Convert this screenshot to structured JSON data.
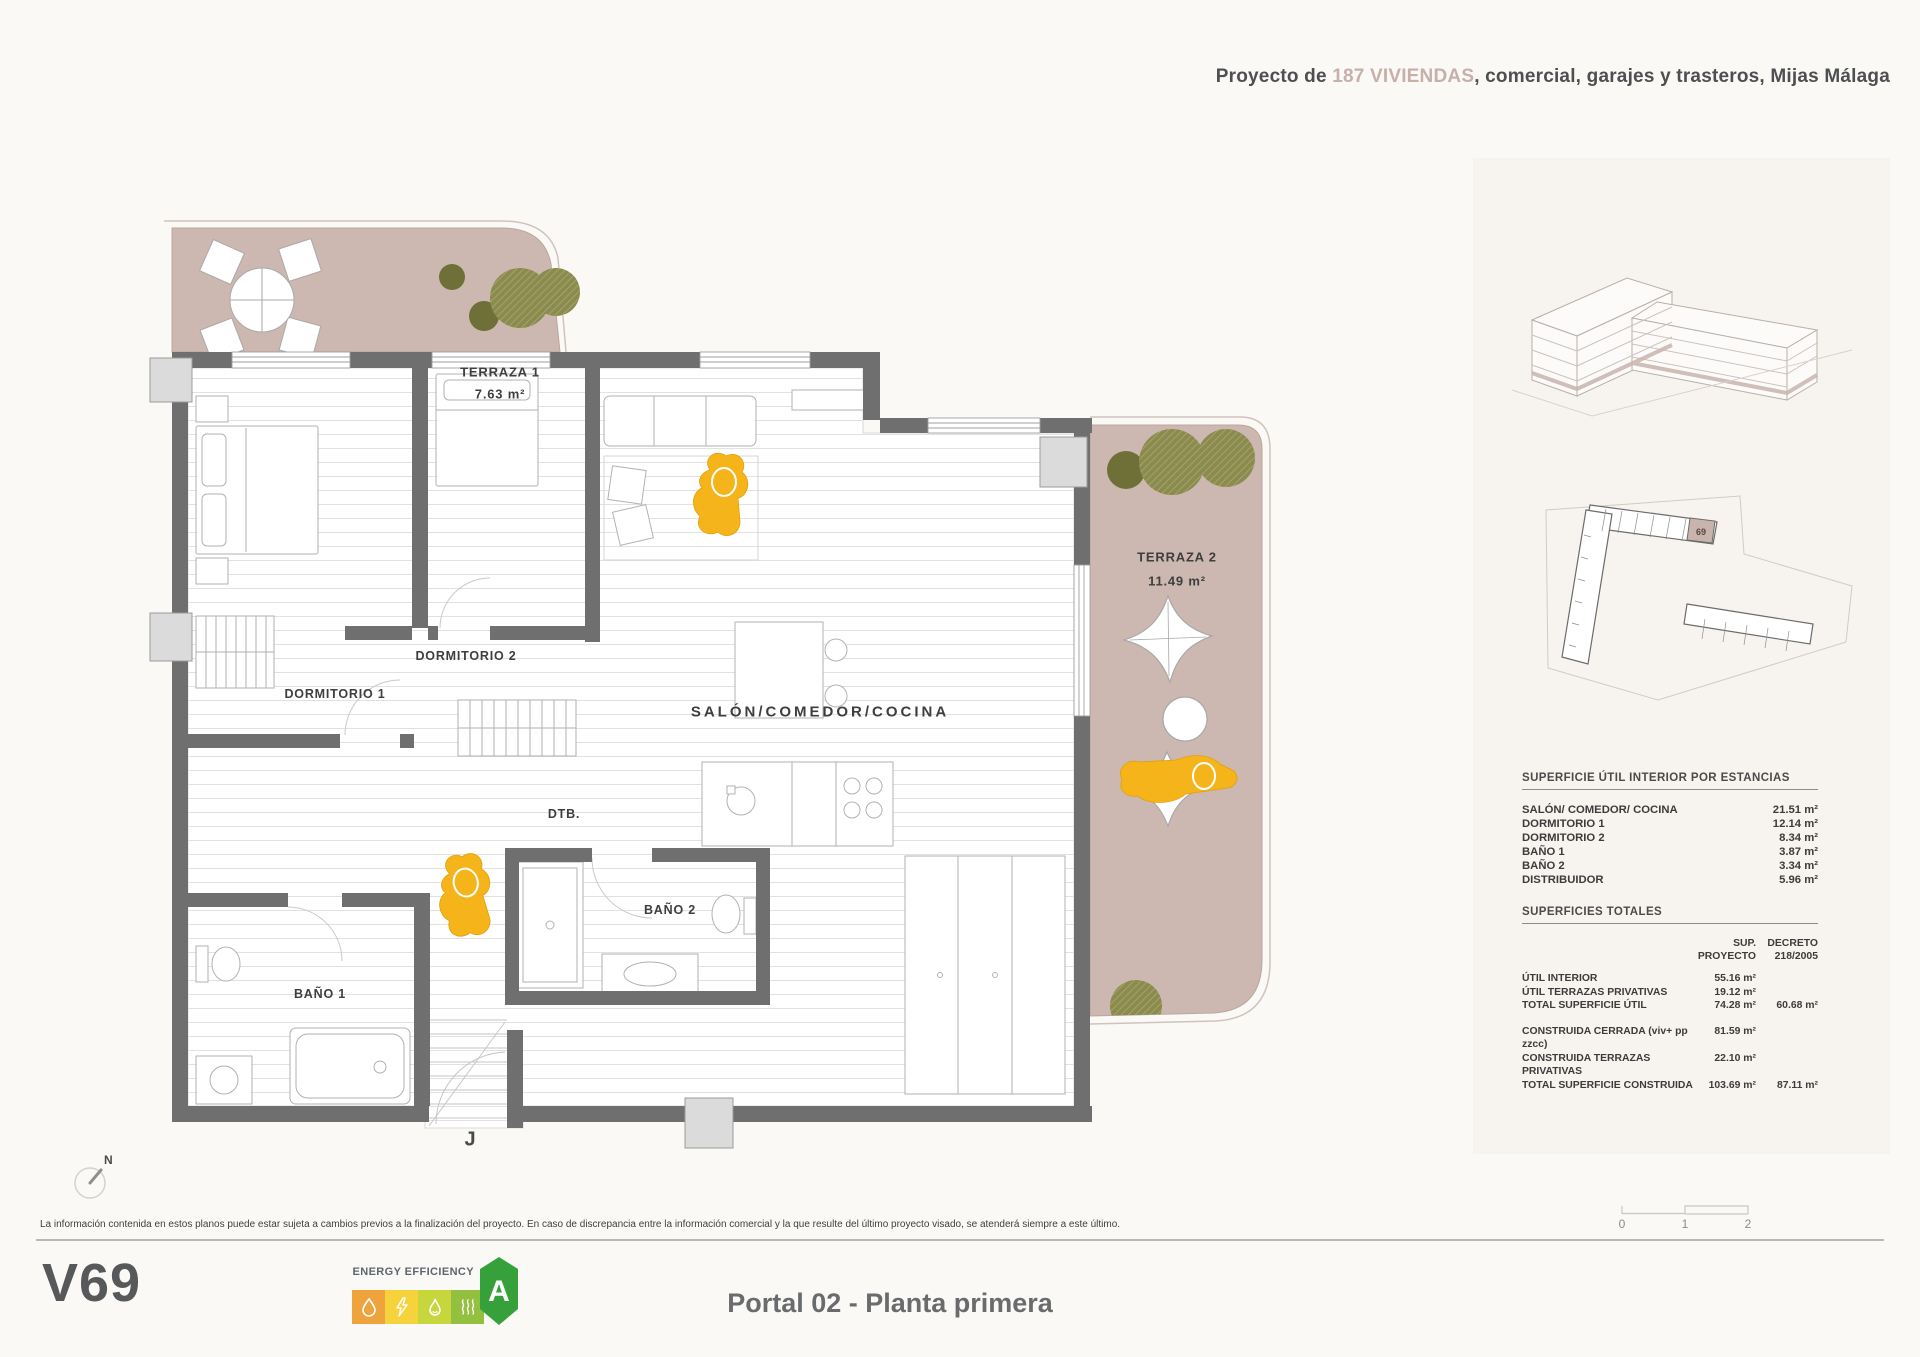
{
  "header": {
    "prefix": "Proyecto de ",
    "highlight": "187 VIVIENDAS",
    "suffix": ", comercial, garajes y trasteros, Mijas Málaga"
  },
  "plan": {
    "terraza1": {
      "name": "TERRAZA 1",
      "area": "7.63 m²"
    },
    "terraza2": {
      "name": "TERRAZA 2",
      "area": "11.49 m²"
    },
    "rooms": {
      "dormitorio1": "DORMITORIO 1",
      "dormitorio2": "DORMITORIO 2",
      "salon": "SALÓN/COMEDOR/COCINA",
      "dtb": "DTB.",
      "bano1": "BAÑO 1",
      "bano2": "BAÑO 2"
    },
    "entry_label": "J",
    "compass": "N"
  },
  "sidebar": {
    "key_unit": "69",
    "interior_table": {
      "title": "SUPERFICIE ÚTIL INTERIOR POR ESTANCIAS",
      "rows": [
        {
          "label": "SALÓN/ COMEDOR/ COCINA",
          "value": "21.51 m²"
        },
        {
          "label": "DORMITORIO 1",
          "value": "12.14 m²"
        },
        {
          "label": "DORMITORIO 2",
          "value": "8.34 m²"
        },
        {
          "label": "BAÑO 1",
          "value": "3.87 m²"
        },
        {
          "label": "BAÑO 2",
          "value": "3.34 m²"
        },
        {
          "label": "DISTRIBUIDOR",
          "value": "5.96 m²"
        }
      ]
    },
    "totals_table": {
      "title": "SUPERFICIES TOTALES",
      "col1_line1": "SUP.",
      "col1_line2": "PROYECTO",
      "col2_line1": "DECRETO",
      "col2_line2": "218/2005",
      "rows": [
        {
          "label": "ÚTIL INTERIOR",
          "sup": "55.16 m²",
          "decreto": ""
        },
        {
          "label": "ÚTIL TERRAZAS PRIVATIVAS",
          "sup": "19.12 m²",
          "decreto": ""
        },
        {
          "label": "TOTAL SUPERFICIE ÚTIL",
          "sup": "74.28 m²",
          "decreto": "60.68 m²"
        },
        {
          "label": "CONSTRUIDA CERRADA (viv+ pp zzcc)",
          "sup": "81.59 m²",
          "decreto": ""
        },
        {
          "label": "CONSTRUIDA TERRAZAS PRIVATIVAS",
          "sup": "22.10 m²",
          "decreto": ""
        },
        {
          "label": "TOTAL SUPERFICIE CONSTRUIDA",
          "sup": "103.69 m²",
          "decreto": "87.11 m²"
        }
      ]
    }
  },
  "scalebar": {
    "labels": [
      "0",
      "1",
      "2"
    ]
  },
  "footer": {
    "disclaimer": "La información contenida en estos planos puede estar sujeta a cambios previos a la finalización del proyecto. En caso de discrepancia entre la información comercial y la que resulte del último proyecto visado, se atenderá siempre a este último.",
    "unit_code": "V69",
    "energy_label": "ENERGY EFFICIENCY",
    "energy_rating": "A",
    "plan_title": "Portal 02 - Planta primera"
  },
  "colors": {
    "terrace": "#ccb8b1",
    "accent_text": "#c7b0a9",
    "wall": "#6f6f6f",
    "person": "#f4b41a",
    "tree_hatch": "#8b8b4f",
    "tree_solid": "#6f7038",
    "energy_a": "#36a13b"
  }
}
